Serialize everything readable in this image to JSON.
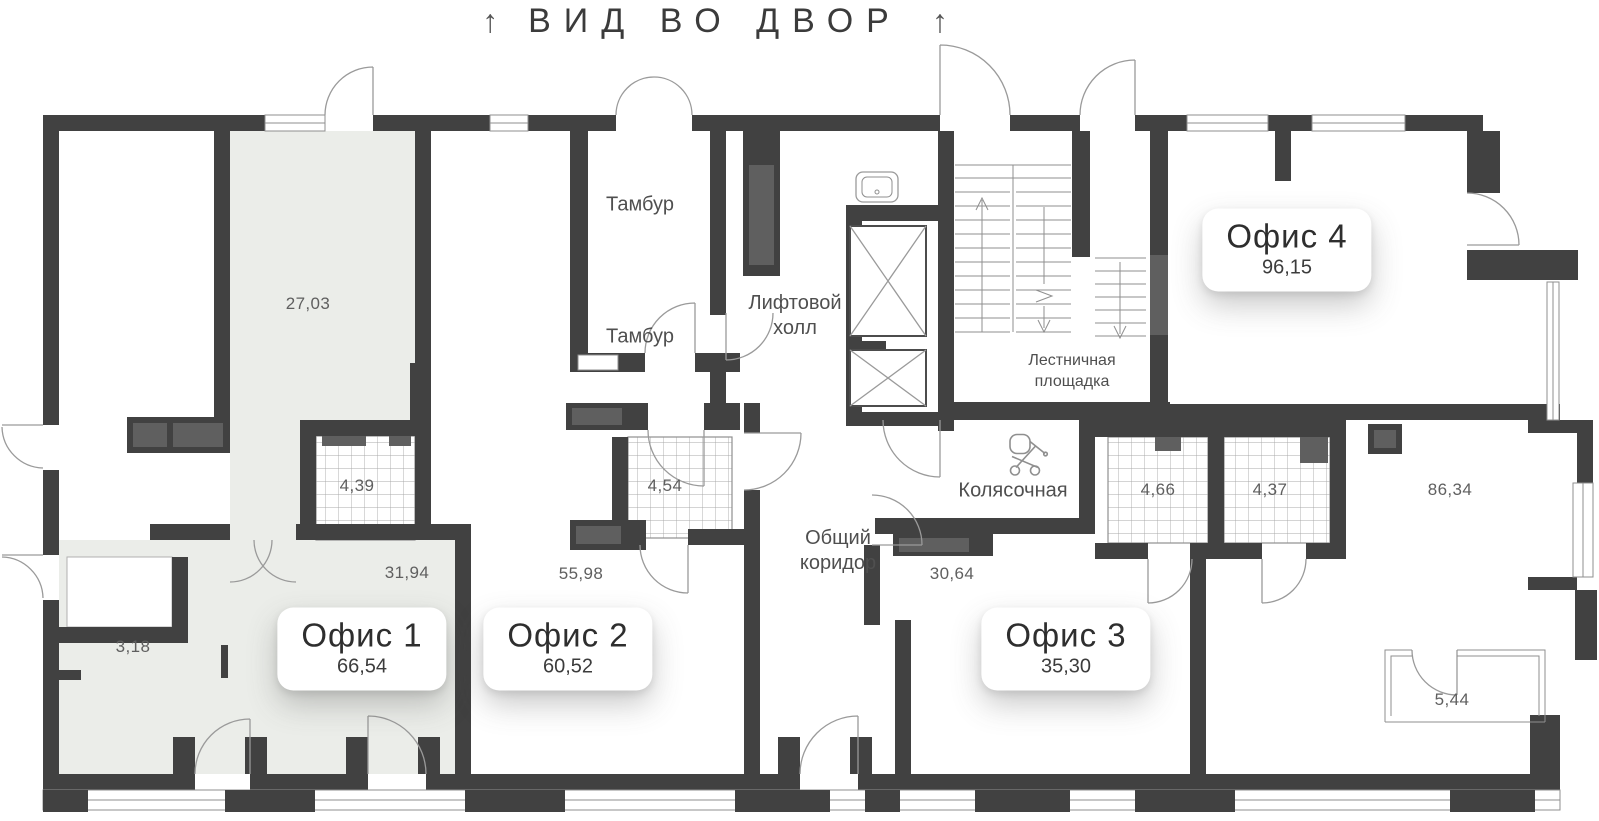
{
  "title": {
    "text": "ВИД ВО ДВОР",
    "arrow_left": "↑",
    "arrow_right": "↑"
  },
  "offices": [
    {
      "name": "Офис 1",
      "area": "66,54"
    },
    {
      "name": "Офис 2",
      "area": "60,52"
    },
    {
      "name": "Офис 3",
      "area": "35,30"
    },
    {
      "name": "Офис 4",
      "area": "96,15"
    }
  ],
  "rooms": {
    "vestibule_upper": "Тамбур",
    "vestibule_lower": "Тамбур",
    "elevator_hall_line1": "Лифтовой",
    "elevator_hall_line2": "холл",
    "stair_landing_line1": "Лестничная",
    "stair_landing_line2": "площадка",
    "stroller_room": "Колясочная",
    "common_corridor_line1": "Общий",
    "common_corridor_line2": "коридор"
  },
  "area_labels": {
    "office1_room": "27,03",
    "office1_bath": "4,39",
    "office1_hall": "31,94",
    "office1_loggia": "3,18",
    "office2_main": "55,98",
    "office2_bath": "4,54",
    "office3_hall": "30,64",
    "bath_left": "4,66",
    "bath_right": "4,37",
    "office4_hall": "86,34",
    "balcony": "5,44"
  },
  "colors": {
    "wall": "#414141",
    "highlight": "#ebede9",
    "thin_line": "#9a9a9a",
    "text": "#4f4f4f",
    "badge_bg": "#ffffff"
  }
}
